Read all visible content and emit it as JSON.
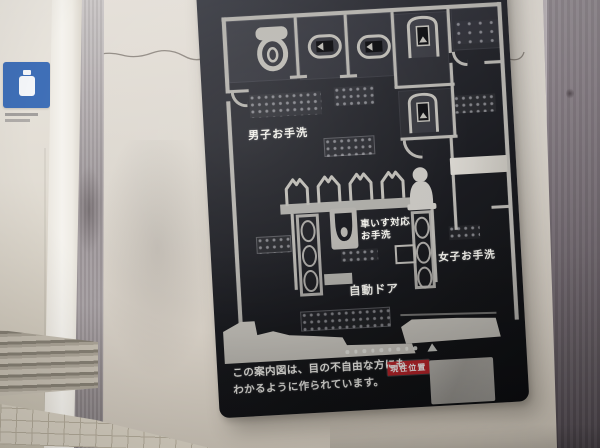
{
  "sign_board": {
    "map_labels": {
      "mens_restroom": "男子お手洗",
      "wheelchair_restroom_line1": "車いす対応",
      "wheelchair_restroom_line2": "お手洗",
      "womens_restroom": "女子お手洗",
      "automatic_door": "自動ドア"
    },
    "current_location_tag": "現在位置",
    "note_line1": "この案内図は、目の不自由な方にも",
    "note_line2": "わかるように作られています。",
    "fixture_icons": [
      "western-toilet-icon",
      "squat-toilet-icon",
      "squat-toilet-icon",
      "booth-toilet-icon",
      "booth-toilet-icon",
      "urinal-icon",
      "urinal-icon",
      "urinal-icon",
      "urinal-icon",
      "accessible-toilet-glyph-icon",
      "wheelchair-toilet-icon",
      "braille-plaque",
      "tactile-dot-strip",
      "position-triangle-icon"
    ],
    "colors": {
      "board_background": "#1c1d22",
      "map_line_silver": "#b5b3ae",
      "label_text": "#f1f0ea",
      "current_location_background": "#c0262c",
      "current_location_text": "#ffffff"
    }
  },
  "environment": {
    "colors": {
      "wall": "#d9d3ca",
      "white_pillar": "#f5f3ee",
      "door_frame_metal": "#a09a9c",
      "right_metal_panel": "#6f666d",
      "blue_sign": "#3f6fb7",
      "blue_stripe": "#3f9fd2",
      "floor_tiles": "#d4cdbf",
      "vent_grille": "#b0a99c"
    }
  }
}
